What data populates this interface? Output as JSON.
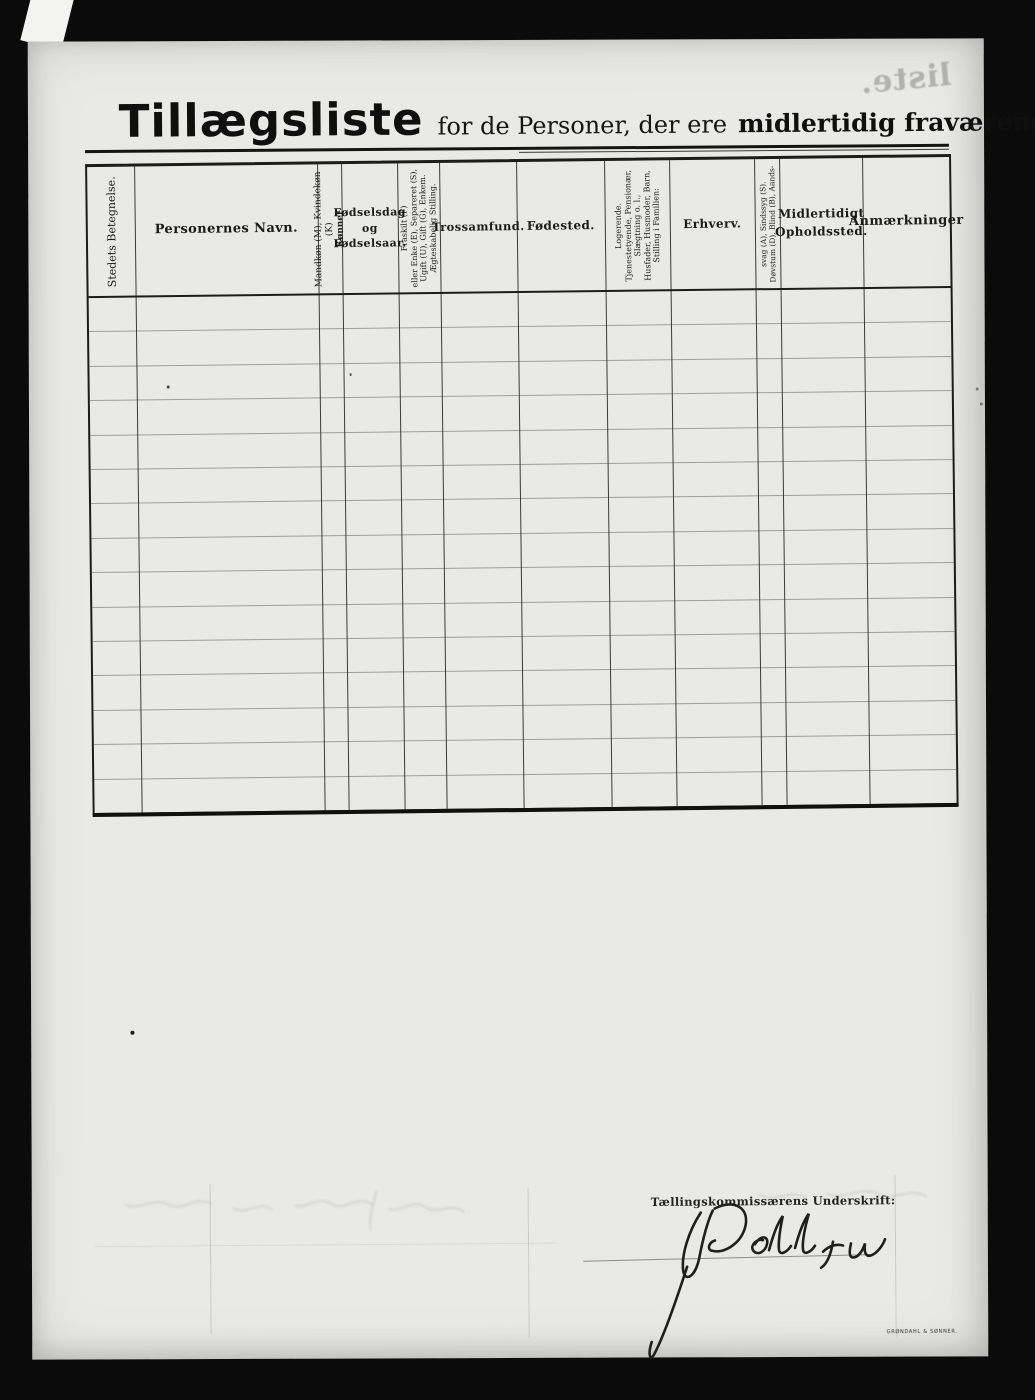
{
  "page": {
    "title": {
      "main": "Tillægsliste",
      "mid": "for de Personer, der ere",
      "emph": "midlertidig fraværende."
    },
    "bleedthrough_text": "liste.",
    "printer_mark": "GRØNDAHL & SØNNER."
  },
  "table": {
    "row_count": 15,
    "columns": [
      {
        "id": "stedets-betegnelse",
        "orientation": "vertical",
        "width_px": 47,
        "font_size": 11,
        "first_line_bold": false,
        "lines": [
          "Stedets Betegnelse."
        ]
      },
      {
        "id": "personernes-navn",
        "orientation": "horizontal",
        "width_px": 183,
        "font_size": 13,
        "bold": true,
        "lines": [
          "Personernes Navn."
        ]
      },
      {
        "id": "konnet",
        "orientation": "vertical",
        "width_px": 24,
        "font_size": 9,
        "first_line_bold": true,
        "lines": [
          "Kønnet",
          "Mandkøn (M), Kvindekøn (K)"
        ]
      },
      {
        "id": "fodselsdag",
        "orientation": "horizontal",
        "width_px": 56,
        "font_size": 11,
        "bold": true,
        "lines": [
          "Fødselsdag",
          "og",
          "Fødselsaar."
        ]
      },
      {
        "id": "aegteskabelig-stilling",
        "orientation": "vertical",
        "width_px": 42,
        "font_size": 8,
        "first_line_bold": false,
        "lines": [
          "Ægteskabelig Stilling.",
          "Ugift (U), Gift (G), Enkem.",
          "eller Enke (E), Separeret (S),",
          "Fraskilt (F)"
        ]
      },
      {
        "id": "trossamfund",
        "orientation": "horizontal",
        "width_px": 77,
        "font_size": 11.5,
        "bold": true,
        "lines": [
          "Trossamfund."
        ]
      },
      {
        "id": "fodested",
        "orientation": "horizontal",
        "width_px": 88,
        "font_size": 12,
        "bold": true,
        "lines": [
          "Fødested."
        ]
      },
      {
        "id": "stilling-i-familien",
        "orientation": "vertical",
        "width_px": 65,
        "font_size": 8,
        "first_line_bold": false,
        "lines": [
          "Stilling i Familien:",
          "Husfader, Husmoder, Barn,",
          "Slægtning o. l.,",
          "Tjenestetyende, Pensionær,",
          "Logerende."
        ]
      },
      {
        "id": "erhverv",
        "orientation": "horizontal",
        "width_px": 85,
        "font_size": 12,
        "bold": true,
        "lines": [
          "Erhverv."
        ]
      },
      {
        "id": "dovstum",
        "orientation": "vertical",
        "width_px": 25,
        "font_size": 7.5,
        "first_line_bold": false,
        "lines": [
          "Døvstum (D), Blind (B), Aands-",
          "svag (A), Sindssyg (S)."
        ]
      },
      {
        "id": "midlertidigt-opholdssted",
        "orientation": "horizontal",
        "width_px": 83,
        "font_size": 12,
        "bold": true,
        "lines": [
          "Midlertidigt",
          "Opholdssted."
        ]
      },
      {
        "id": "anmaerkninger",
        "orientation": "horizontal",
        "width_px": 87,
        "font_size": 13,
        "bold": true,
        "lines": [
          "Anmærkninger"
        ]
      }
    ]
  },
  "signature": {
    "label": "Tællingskommissærens Underskrift:",
    "name_transcription": "J. Dahl jun"
  }
}
